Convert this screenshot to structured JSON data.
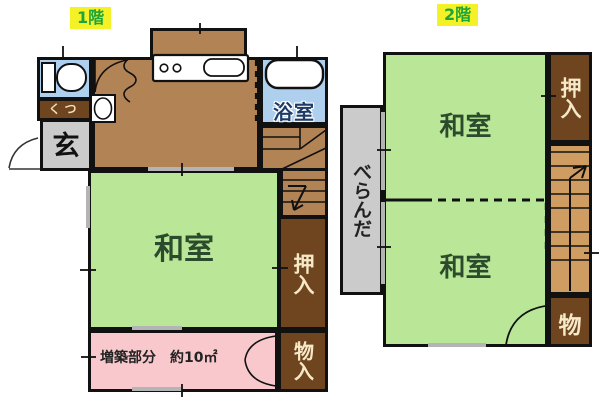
{
  "floor1": {
    "label": "1階",
    "entrance": "玄",
    "shoe_box": "くつ",
    "bathroom": "浴室",
    "tatami_room": "和室",
    "closet": "押入",
    "storage": "物入",
    "extension": "増築部分　約10㎡"
  },
  "floor2": {
    "label": "2階",
    "veranda": "べらんだ",
    "tatami_room_upper": "和室",
    "tatami_room_lower": "和室",
    "closet": "押入",
    "storage": "物"
  },
  "colors": {
    "tatami_green": "#b9e797",
    "wood_brown": "#b28355",
    "closet_brown": "#6f451f",
    "water_blue": "#aecfee",
    "extension_pink": "#f8c8cc",
    "gray": "#cbcbcb",
    "stairs_tan": "#cf9c62",
    "label_bg": "#f4f127",
    "label_text": "#1ba53c"
  },
  "icons": {
    "toilet": "toilet-icon",
    "hand_sink": "sink-icon",
    "stove": "stove-icon",
    "kitchen_sink": "kitchen-sink-icon",
    "bathtub": "bathtub-icon"
  }
}
